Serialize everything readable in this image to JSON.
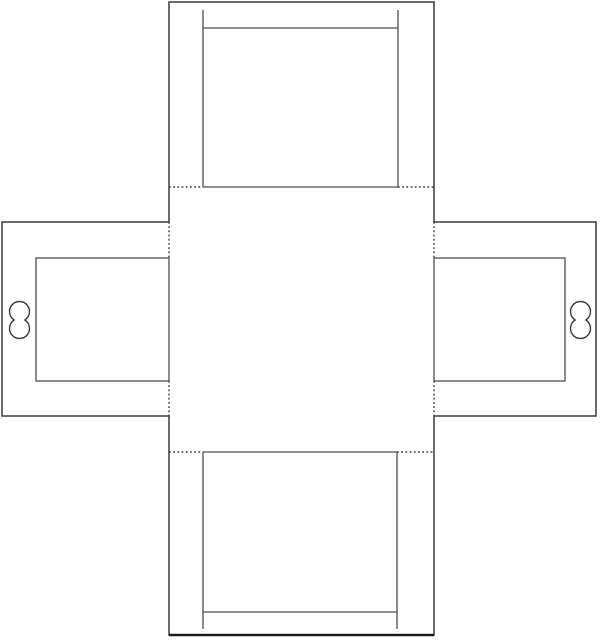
{
  "canvas": {
    "width": 600,
    "height": 641,
    "background": "#ffffff"
  },
  "palette": {
    "cut_line": "#3c3c3c",
    "panel_line": "#4f4f4f",
    "fold_line": "#3c3c3c",
    "hole_line": "#3c3c3c",
    "bottom_edge_accent": "#1e1e1e"
  },
  "strokes": {
    "cut_width": 1.5,
    "panel_width": 1.3,
    "fold_width": 1.4,
    "hole_width": 1.4,
    "fold_dash": "1.8 2.4"
  },
  "diagram": {
    "kind": "papercraft-box-net-template",
    "outline_points": "169,2 434,2 434,222 596,222 596,416 434,416 434,635 169,635 169,416 2,416 2,222 169,222",
    "fold_segments": [
      {
        "name": "fold-top-left-segment",
        "x1": 169,
        "y1": 187,
        "x2": 203,
        "y2": 187
      },
      {
        "name": "fold-top-right-segment",
        "x1": 398,
        "y1": 187,
        "x2": 434,
        "y2": 187
      },
      {
        "name": "fold-bottom-left-segment",
        "x1": 169,
        "y1": 452,
        "x2": 203,
        "y2": 452
      },
      {
        "name": "fold-bottom-right-segment",
        "x1": 397,
        "y1": 452,
        "x2": 434,
        "y2": 452
      },
      {
        "name": "fold-left-upper-segment",
        "x1": 169,
        "y1": 222,
        "x2": 169,
        "y2": 258
      },
      {
        "name": "fold-left-lower-segment",
        "x1": 169,
        "y1": 381,
        "x2": 169,
        "y2": 416
      },
      {
        "name": "fold-right-upper-segment",
        "x1": 434,
        "y1": 222,
        "x2": 434,
        "y2": 258
      },
      {
        "name": "fold-right-lower-segment",
        "x1": 434,
        "y1": 381,
        "x2": 434,
        "y2": 416
      }
    ],
    "panel_segments": [
      {
        "name": "top-lid-left-cut",
        "x1": 203,
        "y1": 10,
        "x2": 203,
        "y2": 187
      },
      {
        "name": "top-lid-right-cut",
        "x1": 398,
        "y1": 10,
        "x2": 398,
        "y2": 187
      },
      {
        "name": "top-lid-crease",
        "x1": 203,
        "y1": 28,
        "x2": 398,
        "y2": 28
      },
      {
        "name": "top-lid-base",
        "x1": 203,
        "y1": 187,
        "x2": 398,
        "y2": 187
      },
      {
        "name": "bottom-lid-left-cut",
        "x1": 203,
        "y1": 452,
        "x2": 203,
        "y2": 629
      },
      {
        "name": "bottom-lid-right-cut",
        "x1": 397,
        "y1": 452,
        "x2": 397,
        "y2": 629
      },
      {
        "name": "bottom-lid-crease",
        "x1": 203,
        "y1": 612,
        "x2": 397,
        "y2": 612
      },
      {
        "name": "bottom-lid-base",
        "x1": 203,
        "y1": 452,
        "x2": 397,
        "y2": 452
      }
    ],
    "window_frames": [
      {
        "name": "left-flap-window-frame",
        "x": 36,
        "y": 258,
        "width": 133,
        "height": 123
      },
      {
        "name": "right-flap-window-frame",
        "x": 434,
        "y": 258,
        "width": 131,
        "height": 123
      }
    ],
    "hanging_holes": [
      {
        "name": "left-flap-hanging-hole",
        "cx": 19.5,
        "cy_top": 311.5,
        "cy_bottom": 328.5,
        "r": 10
      },
      {
        "name": "right-flap-hanging-hole",
        "cx": 580.5,
        "cy_top": 311.5,
        "cy_bottom": 328.5,
        "r": 10
      }
    ],
    "accent_segments": [
      {
        "name": "bottom-flap-bottom-edge",
        "x1": 169,
        "y1": 635,
        "x2": 434,
        "y2": 635,
        "width": 2.6
      }
    ]
  }
}
